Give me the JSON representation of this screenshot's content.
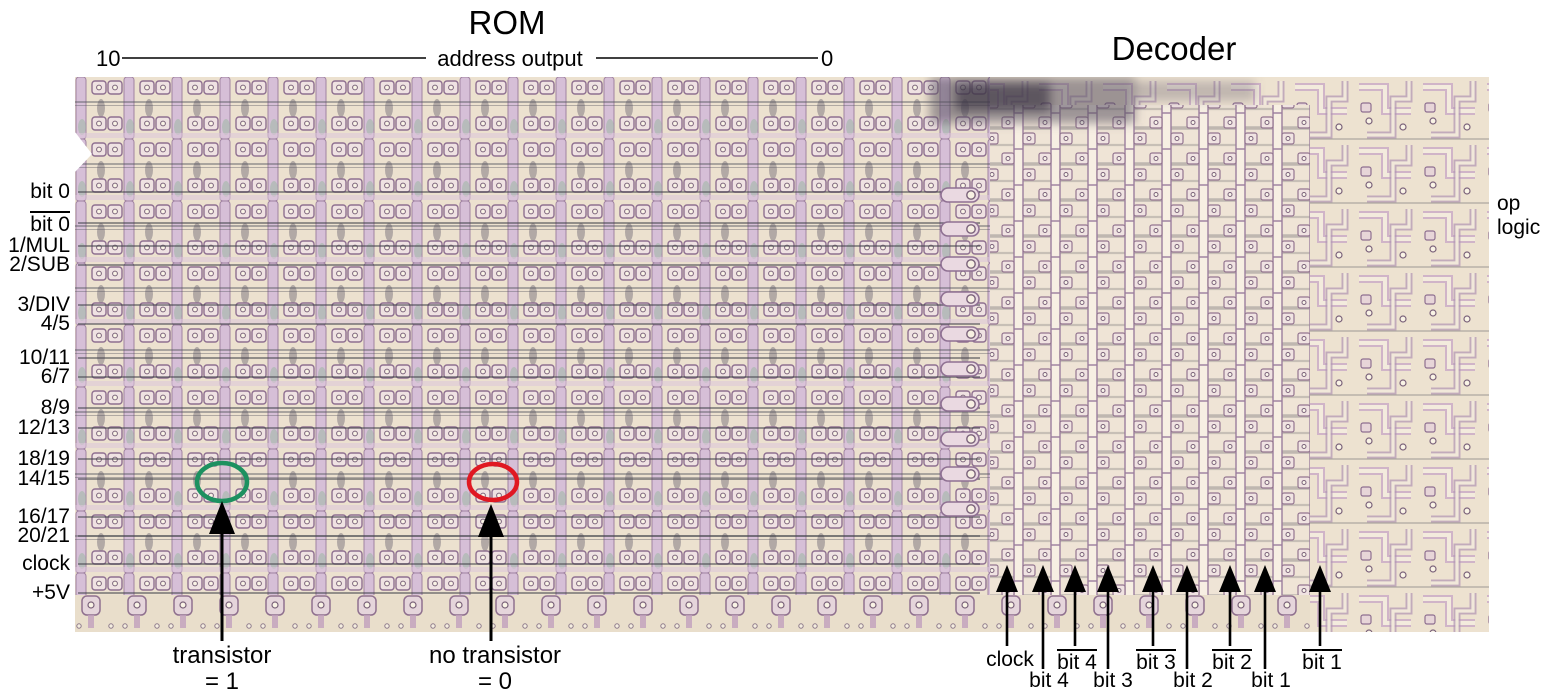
{
  "titles": {
    "rom": "ROM",
    "decoder": "Decoder"
  },
  "address_scale": {
    "left_tick": "10",
    "label": "address output",
    "right_tick": "0"
  },
  "rom_row_labels": [
    {
      "text": "bit 0",
      "overline": false
    },
    {
      "text": "bit 0",
      "overline": true
    },
    {
      "text": "1/MUL",
      "overline": false
    },
    {
      "text": "2/SUB",
      "overline": false
    },
    {
      "text": "3/DIV",
      "overline": false
    },
    {
      "text": "4/5",
      "overline": false
    },
    {
      "text": "10/11",
      "overline": false
    },
    {
      "text": "6/7",
      "overline": false
    },
    {
      "text": "8/9",
      "overline": false
    },
    {
      "text": "12/13",
      "overline": false
    },
    {
      "text": "18/19",
      "overline": false
    },
    {
      "text": "14/15",
      "overline": false
    },
    {
      "text": "16/17",
      "overline": false
    },
    {
      "text": "20/21",
      "overline": false
    },
    {
      "text": "clock",
      "overline": false
    },
    {
      "text": "+5V",
      "overline": false
    }
  ],
  "right_label": {
    "line1": "op",
    "line2": "logic"
  },
  "legend": {
    "transistor": {
      "label": "transistor",
      "value": "= 1",
      "circle_color": "#1d9160"
    },
    "no_transistor": {
      "label": "no transistor",
      "value": "= 0",
      "circle_color": "#e01822"
    }
  },
  "decoder_signals": [
    {
      "text": "clock",
      "overline": false,
      "row": "top"
    },
    {
      "text": "bit 4",
      "overline": false,
      "row": "bottom"
    },
    {
      "text": "bit 4",
      "overline": true,
      "row": "top"
    },
    {
      "text": "bit 3",
      "overline": false,
      "row": "bottom"
    },
    {
      "text": "bit 3",
      "overline": true,
      "row": "top"
    },
    {
      "text": "bit 2",
      "overline": false,
      "row": "bottom"
    },
    {
      "text": "bit 2",
      "overline": true,
      "row": "top"
    },
    {
      "text": "bit 1",
      "overline": false,
      "row": "bottom"
    },
    {
      "text": "bit 1",
      "overline": true,
      "row": "top"
    }
  ],
  "colors": {
    "annotation_green": "#1d9160",
    "annotation_red": "#e01822",
    "annotation_black": "#000000",
    "die_background": "#ece1cf",
    "die_trace_pink": "#d6bfd7",
    "die_trace_outline": "#8e6f90",
    "die_dark_line": "#54555e",
    "die_contact_white": "#faf4e6"
  }
}
